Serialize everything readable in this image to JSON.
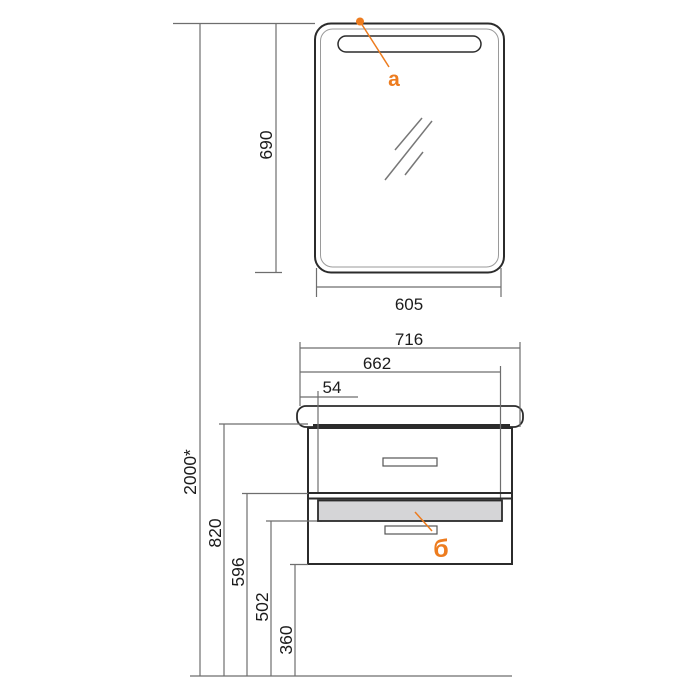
{
  "diagram": {
    "type": "technical-drawing",
    "subject": "bathroom mirror and wall-hung vanity cabinet, front elevation with dimensions"
  },
  "callouts": {
    "a": "a",
    "b": "б"
  },
  "dimensions": {
    "install_height": "2000*",
    "cabinet_top_height": "820",
    "divider_height": "596",
    "drawer_bottom_height": "502",
    "cabinet_bottom_height": "360",
    "mirror_height": "690",
    "mirror_width": "605",
    "total_width": "716",
    "body_width": "662",
    "side_offset": "54"
  },
  "colors": {
    "accent_orange": "#ED7C1F",
    "outline_dark": "#2b2b2b",
    "dim_line_gray": "#6e6e6e",
    "drawer_fill_gray": "#d5d5d7",
    "background": "#ffffff"
  }
}
